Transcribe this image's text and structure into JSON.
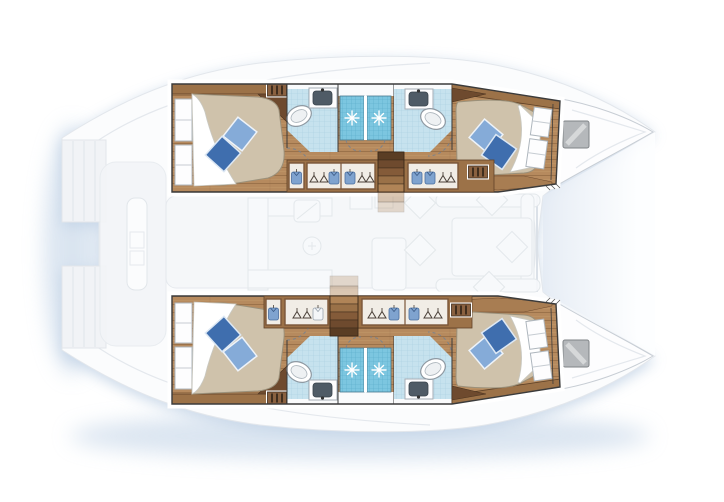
{
  "page": {
    "title": "Catamaran yacht floor plan — top view, 4-cabin layout",
    "background": "#ffffff"
  },
  "vessel": {
    "type": "sailing catamaran floor plan (top view)",
    "orientation": {
      "bow": "right",
      "stern": "left"
    },
    "hull_count": 2,
    "cabin_count": 4,
    "bathroom_count": 4,
    "shower_count": 4,
    "rendering_note": "hull interiors drawn in full color; saloon, cockpit, foredeck and decks shown faded"
  },
  "hulls": [
    {
      "id": "top-hull",
      "rooms": [
        {
          "name": "aft cabin",
          "furniture": [
            "double berth",
            "dark blue pillow",
            "light blue pillow",
            "white sheet",
            "two hull windows",
            "shelf band",
            "vent grate"
          ]
        },
        {
          "name": "aft bathroom",
          "furniture": [
            "toilet",
            "washbasin with faucet",
            "shower cabin with sparkle"
          ]
        },
        {
          "name": "forward bathroom",
          "furniture": [
            "toilet",
            "washbasin with faucet",
            "shower cabin with sparkle"
          ]
        },
        {
          "name": "forward cabin",
          "furniture": [
            "double berth",
            "dark blue pillow",
            "light blue pillow",
            "white sheet",
            "two hull windows",
            "foot shelf",
            "vent grate"
          ]
        }
      ],
      "stairs": "companionway stairs from saloon, between the two bathrooms",
      "wardrobes": "hanging lockers with shirts and hangers along inboard wall"
    },
    {
      "id": "bottom-hull",
      "rooms": [
        {
          "name": "aft cabin",
          "furniture": [
            "double berth",
            "dark blue pillow",
            "light blue pillow",
            "white sheet",
            "two hull windows",
            "shelf band",
            "vent grate"
          ]
        },
        {
          "name": "aft bathroom",
          "furniture": [
            "toilet",
            "washbasin with faucet",
            "shower cabin with sparkle"
          ]
        },
        {
          "name": "forward bathroom",
          "furniture": [
            "toilet",
            "washbasin with faucet",
            "shower cabin with sparkle"
          ]
        },
        {
          "name": "forward cabin",
          "furniture": [
            "double berth",
            "dark blue pillow",
            "light blue pillow",
            "white sheet",
            "two hull windows",
            "foot shelf",
            "vent grate"
          ]
        }
      ],
      "stairs": "companionway stairs from saloon, aft of the bathrooms",
      "wardrobes": "hanging lockers with shirts and hangers along inboard wall"
    }
  ],
  "center": {
    "cockpit": "aft cockpit with bench seat (faded)",
    "saloon": "galley with sink, burners and counters (faded)",
    "dinette": "table with U-shaped sofa and cushions (faded)",
    "foredeck": "gradient wedge between the two bows (faded)",
    "transom_platforms": "stepped swim platforms at both sterns"
  },
  "bows": [
    {
      "id": "top-bow",
      "deck_hatch": true
    },
    {
      "id": "bottom-bow",
      "deck_hatch": true
    }
  ],
  "colors": {
    "background": "#ffffff",
    "shadow": "#bfd0e4",
    "deck": "#fbfcfd",
    "outline": "#3b3b3b",
    "wood_floor": "#b68a5e",
    "wood_band": "#9c7248",
    "wood_dark": "#6e4a2e",
    "wardrobe_frame": "#7b5639",
    "mattress": "#cfc2ab",
    "sheet": "#ffffff",
    "pillow_dark": "#3f6eae",
    "pillow_light": "#85abd8",
    "bath_floor": "#c6e2ee",
    "shower_tile": "#7cc6e0",
    "basin_gray": "#4f5b66",
    "hatch_gray": "#b5b8bb",
    "faded_stroke": "#e1e6ea",
    "stairs_light": "#b08457",
    "stairs_dark": "#5a3d24"
  }
}
